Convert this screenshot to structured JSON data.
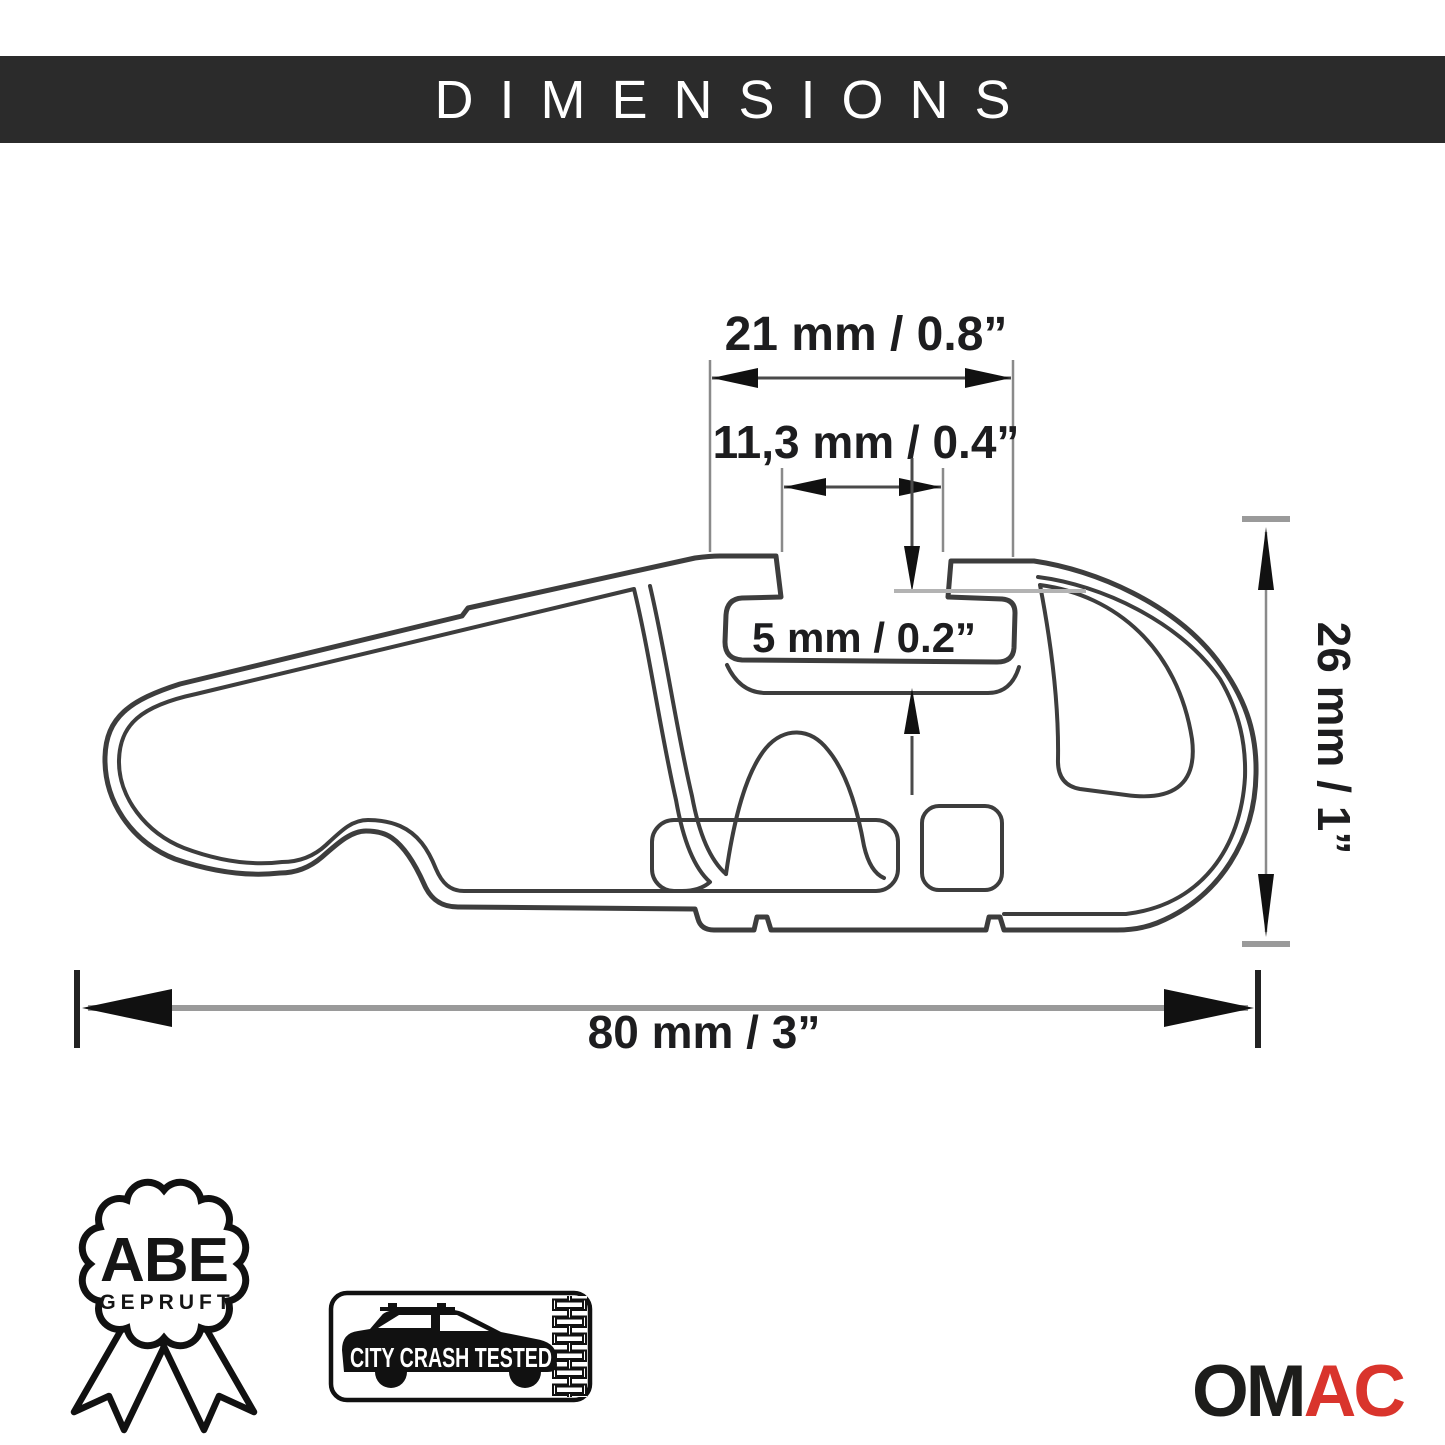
{
  "header": {
    "title": "DIMENSIONS",
    "bar_color": "#2b2b2b",
    "text_color": "#ffffff"
  },
  "drawing": {
    "description": "cross-section profile of aluminum roof rack crossbar",
    "line_color": "#3d3d3d",
    "dim_top_width": {
      "label": "21 mm / 0.8”"
    },
    "dim_slot_width": {
      "label": "11,3 mm / 0.4”"
    },
    "dim_slot_depth": {
      "label": "5 mm / 0.2”"
    },
    "dim_height": {
      "label": "26 mm / 1”"
    },
    "dim_overall_width": {
      "label": "80 mm / 3”"
    }
  },
  "badges": {
    "abe": {
      "title": "ABE",
      "subtitle": "GEPRUFT"
    },
    "crash_test": {
      "label": "CITY CRASH TESTED"
    }
  },
  "brand": {
    "prefix": "OM",
    "suffix": "AC",
    "prefix_color": "#1d1d1b",
    "suffix_color": "#d9342c"
  }
}
